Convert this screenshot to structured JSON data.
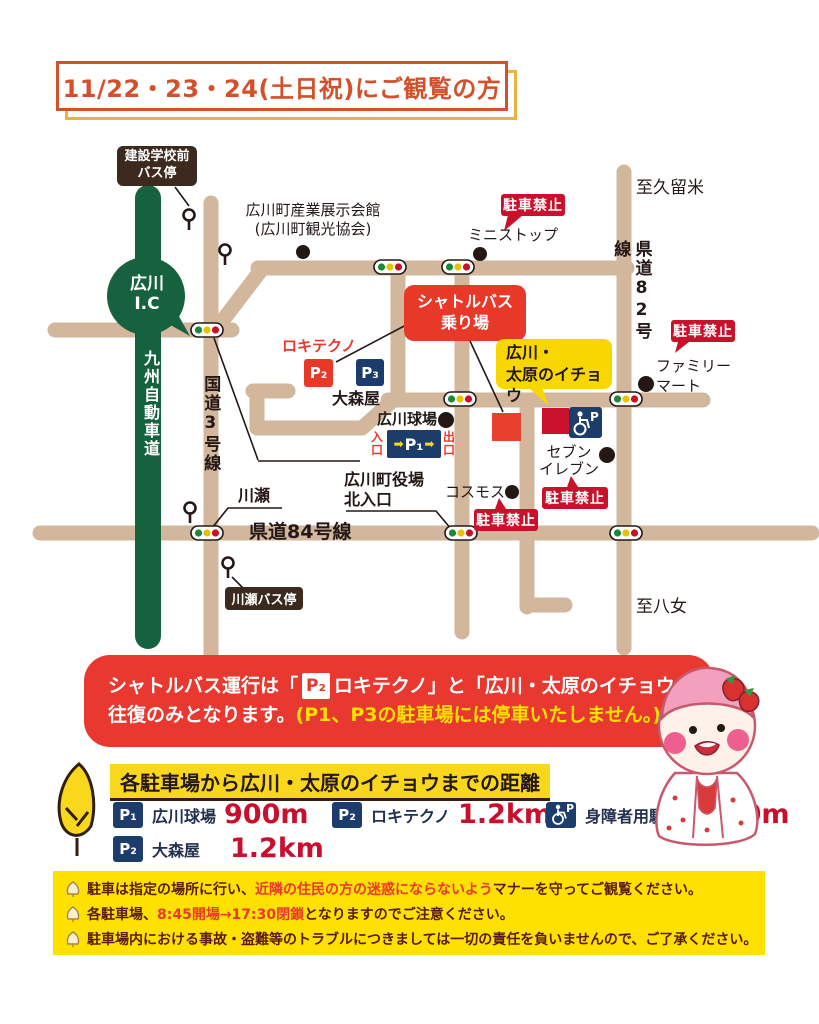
{
  "title": "11/22・23・24(土日祝)にご観覧の方",
  "colors": {
    "road": "#d2b79c",
    "expressway_green": "#17623e",
    "badge_red": "#c9112c",
    "accent_red": "#e8382f",
    "navy": "#1c3d6b",
    "yellow": "#f9d71c",
    "notice_bg": "#ffe100",
    "dark_brown": "#3b2a1d",
    "text_dark": "#231815"
  },
  "map": {
    "kensetsu_bus_stop": "建設学校前\nバス停",
    "exhibition_hall": "広川町産業展示会館\n(広川町観光協会)",
    "ministop": "ミニストップ",
    "no_parking": "駐車禁止",
    "to_kurume": "至久留米",
    "kendo82": "県道82号線",
    "shuttle_stop": "シャトルバス\n乗り場",
    "rokitechno": "ロキテクノ",
    "p1": "P₁",
    "p2": "P₂",
    "p3": "P₃",
    "omoriya": "大森屋",
    "ballpark": "広川球場",
    "entrance": "入口",
    "exit": "出口",
    "arrow": "➡",
    "icho": "広川・\n太原のイチョウ",
    "familymart": "ファミリー\nマート",
    "seven_eleven": "セブン\nイレブン",
    "cosmos": "コスモス",
    "yakuba_kitaguchi": "広川町役場\n北入口",
    "kawase": "川瀬",
    "kendo84": "県道84号線",
    "kawase_bus_stop": "川瀬バス停",
    "to_yame": "至八女",
    "kokudo3": "国道3号線",
    "expressway": "九州自動車道",
    "ic": "広川\nI.C"
  },
  "banner": {
    "line1_pre": "シャトルバス運行は「",
    "chip": "P₂",
    "line1_post": "ロキテクノ」と「広川・太原のイチョウ」の",
    "line2_white": "往復のみとなります。",
    "line2_yellow": "(P1、P3の駐車場には停車いたしません。)"
  },
  "distance": {
    "heading": "各駐車場から広川・太原のイチョウまでの距離",
    "accessible_chip_p": "P",
    "items": [
      {
        "chip": "P₁",
        "name": "広川球場",
        "value": "900m"
      },
      {
        "chip": "P₂",
        "name": "ロキテクノ",
        "value": "1.2km"
      },
      {
        "chip": "♿",
        "name": "身障者用駐車場",
        "value": "200m"
      },
      {
        "chip": "P₂",
        "name": "大森屋",
        "value": "1.2km"
      }
    ]
  },
  "notices": {
    "line1": [
      {
        "t": "駐車は指定の場所に行い、"
      },
      {
        "t": "近隣の住民の方の迷惑にならないよう"
      },
      {
        "t": "マナーを守ってご観覧ください。"
      }
    ],
    "line2": [
      {
        "t": "各駐車場、"
      },
      {
        "t": "8:45開場→17:30閉鎖"
      },
      {
        "t": "となりますのでご注意ください。"
      }
    ],
    "line3": [
      {
        "t": "駐車場内における事故・盗難等のトラブルにつきましては一切の責任を負いませんので、ご了承ください。"
      }
    ]
  }
}
